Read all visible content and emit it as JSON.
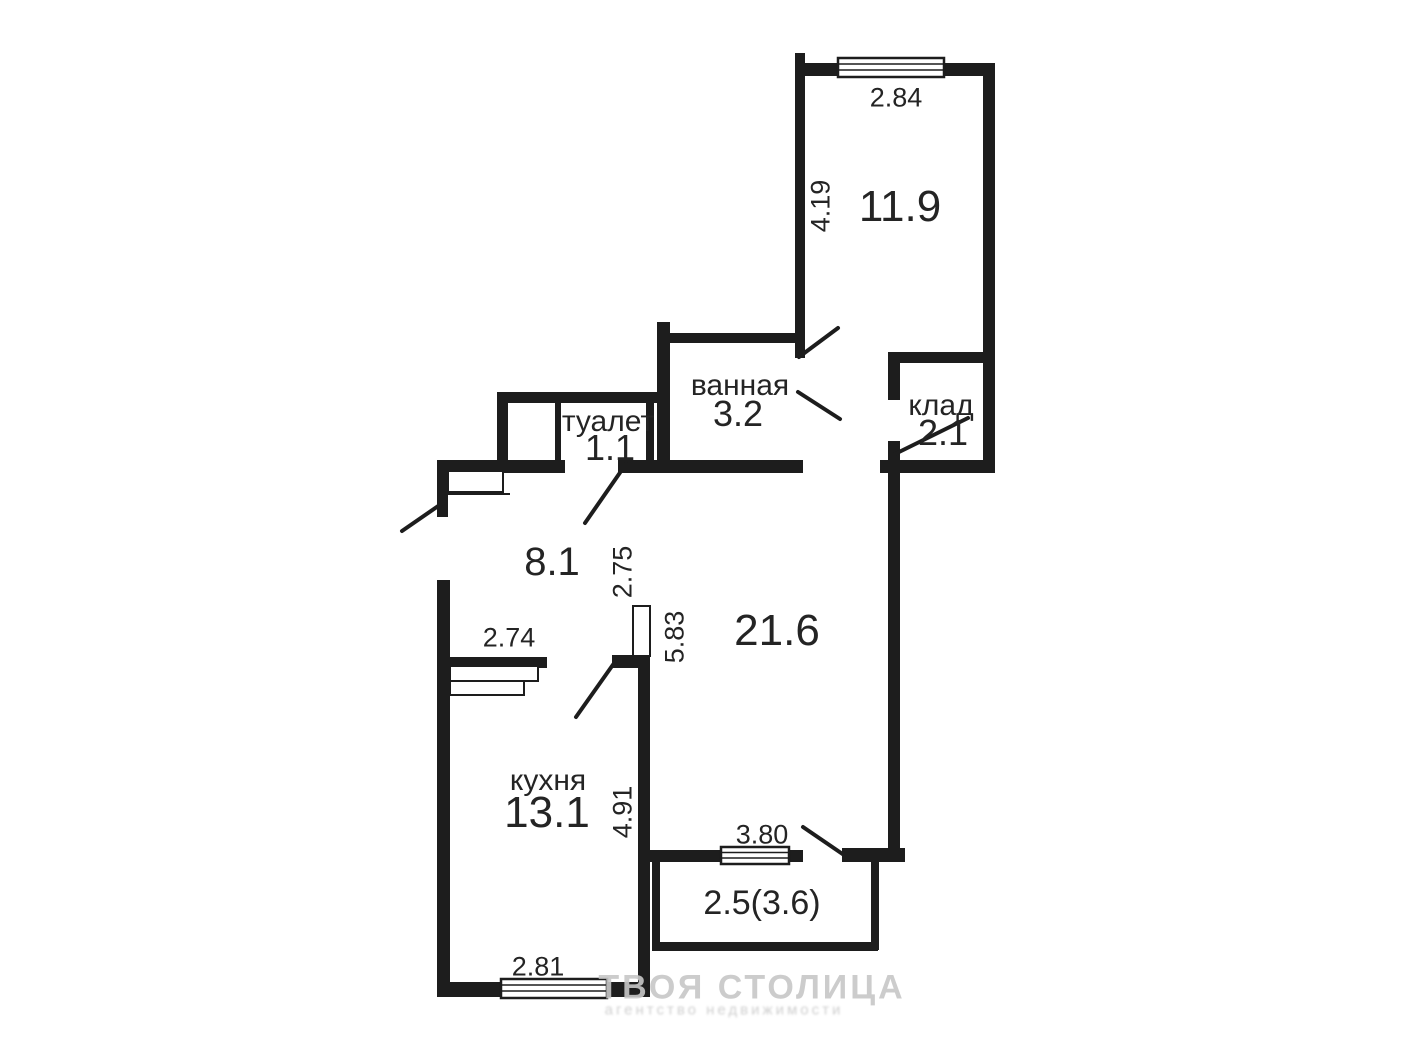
{
  "plan": {
    "background_color": "#ffffff",
    "wall_color": "#1d1d1d",
    "text_color": "#242424",
    "rooms": {
      "bedroom": {
        "area": "11.9",
        "dim_width": "2.84",
        "dim_height": "4.19"
      },
      "bathroom": {
        "name": "ванная",
        "area": "3.2"
      },
      "storage": {
        "name": "клад",
        "area": "2.1"
      },
      "toilet": {
        "name": "туалет",
        "area": "1.1"
      },
      "hallway": {
        "area": "8.1",
        "dim_height": "2.75"
      },
      "living": {
        "area": "21.6",
        "dim_height": "5.83"
      },
      "kitchen": {
        "name": "кухня",
        "area": "13.1",
        "dim_width_top": "2.74",
        "dim_height": "4.91",
        "dim_window": "2.81"
      },
      "balcony": {
        "area": "2.5(3.6)",
        "dim_width": "3.80"
      }
    },
    "watermark": {
      "title": "ТВОЯ СТОЛИЦА",
      "subtitle": "агентство недвижимости",
      "color": "#c7c7c7"
    }
  }
}
